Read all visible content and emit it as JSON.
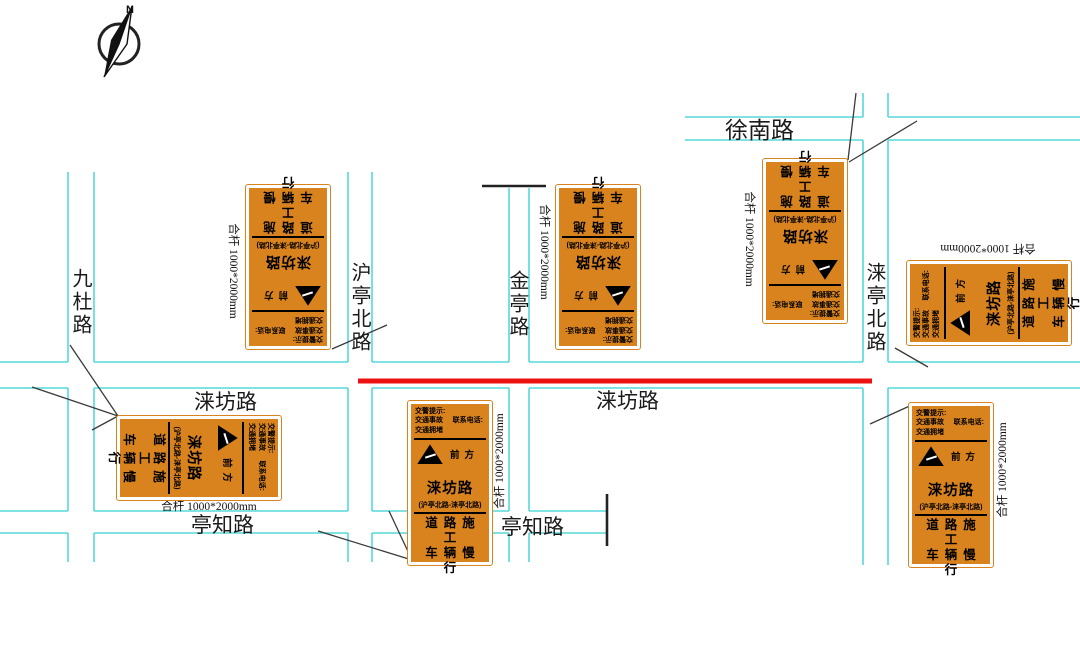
{
  "compass": {
    "n": "N"
  },
  "roads": {
    "xunan": "徐南路",
    "laifang": "涞坊路",
    "tingzhi": "亭知路",
    "jiudu": "九杜路",
    "hutingbei": "沪亭北路",
    "jinting": "金亭路",
    "laitingbei": "涞亭北路"
  },
  "sign": {
    "warn_title": "交警提示:",
    "warn_line2a": "交通事故",
    "warn_line2b": "联系电话:",
    "warn_line3": "交通拥堵",
    "ahead": "前方",
    "road_name": "涞坊路",
    "section": "(沪亭北路-涞亭北路)",
    "bottom_line1": "道路施工",
    "bottom_line2": "车辆慢行"
  },
  "pole_label": "合杆 1000*2000mm",
  "colors": {
    "road": "#56d8d8",
    "construction": "#ed1212",
    "sign": "#d9831f"
  }
}
